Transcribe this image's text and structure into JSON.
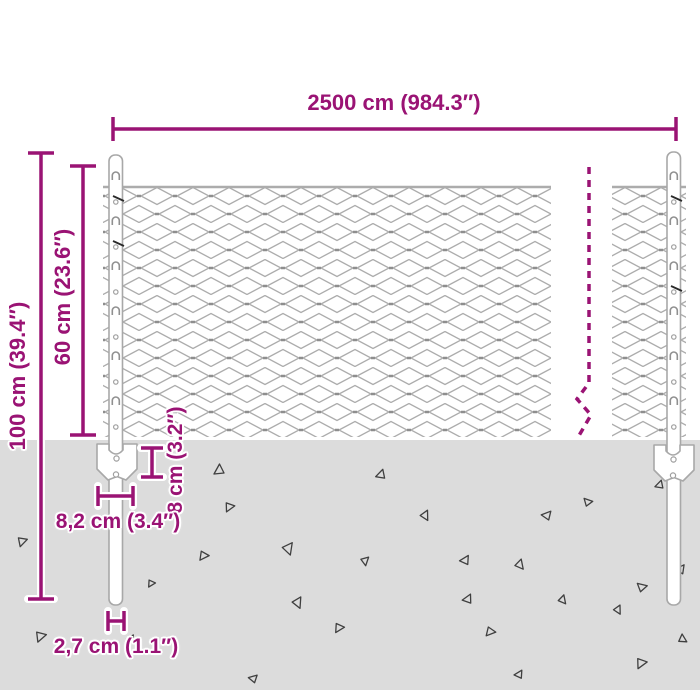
{
  "title": "Wire mesh fence dimension diagram",
  "colors": {
    "accent": "#9A1374",
    "ground": "#DCDCDC",
    "wire": "#ACACAC",
    "wire_dark": "#8E8E8E",
    "triangle": "#3F3F3F",
    "post_stroke": "#A8A8A8"
  },
  "dimensions": {
    "total_width": {
      "label": "2500 cm (984.3″)"
    },
    "total_height": {
      "label": "100 cm (39.4″)"
    },
    "mesh_height": {
      "label": "60 cm (23.6″)"
    },
    "plate_height": {
      "label": "8 cm (3.2″)"
    },
    "plate_width": {
      "label": "8,2 cm (3.4″)"
    },
    "post_width": {
      "label": "2,7 cm (1.1″)"
    }
  },
  "ground": {
    "triangles": [
      {
        "x": 214,
        "y": 464,
        "s": 10,
        "r": 0
      },
      {
        "x": 378,
        "y": 468,
        "s": 9,
        "r": 15
      },
      {
        "x": 25,
        "y": 548,
        "s": 9,
        "r": 195
      },
      {
        "x": 231,
        "y": 514,
        "s": 9,
        "r": 205
      },
      {
        "x": 432,
        "y": 518,
        "s": 9,
        "r": 150
      },
      {
        "x": 296,
        "y": 553,
        "s": 11,
        "r": 160
      },
      {
        "x": 464,
        "y": 553,
        "s": 9,
        "r": 30
      },
      {
        "x": 547,
        "y": 508,
        "s": 9,
        "r": 40
      },
      {
        "x": 592,
        "y": 497,
        "s": 8,
        "r": 80
      },
      {
        "x": 204,
        "y": 563,
        "s": 9,
        "r": 215
      },
      {
        "x": 370,
        "y": 565,
        "s": 8,
        "r": 170
      },
      {
        "x": 527,
        "y": 566,
        "s": 9,
        "r": 140
      },
      {
        "x": 657,
        "y": 479,
        "s": 8,
        "r": 15
      },
      {
        "x": 43,
        "y": 644,
        "s": 10,
        "r": 200
      },
      {
        "x": 305,
        "y": 606,
        "s": 10,
        "r": 155
      },
      {
        "x": 340,
        "y": 635,
        "s": 9,
        "r": 210
      },
      {
        "x": 466,
        "y": 592,
        "s": 9,
        "r": 25
      },
      {
        "x": 490,
        "y": 639,
        "s": 9,
        "r": 220
      },
      {
        "x": 518,
        "y": 668,
        "s": 8,
        "r": 30
      },
      {
        "x": 569,
        "y": 601,
        "s": 8,
        "r": 140
      },
      {
        "x": 646,
        "y": 581,
        "s": 9,
        "r": 75
      },
      {
        "x": 643,
        "y": 671,
        "s": 10,
        "r": 205
      },
      {
        "x": 624,
        "y": 612,
        "s": 8,
        "r": 150
      },
      {
        "x": 680,
        "y": 562,
        "s": 9,
        "r": 35
      },
      {
        "x": 130,
        "y": 633,
        "s": 7,
        "r": 30
      },
      {
        "x": 254,
        "y": 672,
        "s": 8,
        "r": 45
      },
      {
        "x": 152,
        "y": 589,
        "s": 7,
        "r": 210
      },
      {
        "x": 689,
        "y": 638,
        "s": 8,
        "r": 120
      }
    ]
  }
}
